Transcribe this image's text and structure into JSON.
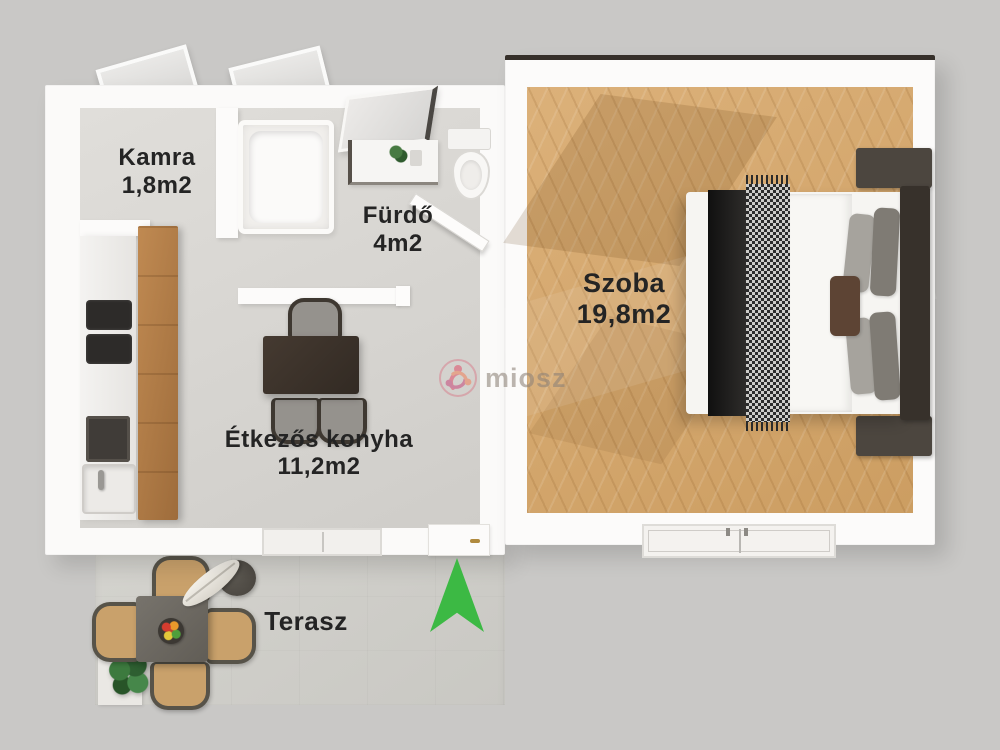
{
  "floorplan": {
    "rooms": [
      {
        "name": "Kamra",
        "area": "1,8m2"
      },
      {
        "name": "Fürdő",
        "area": "4m2"
      },
      {
        "name": "Szoba",
        "area": "19,8m2"
      },
      {
        "name": "Étkezős konyha",
        "area": "11,2m2"
      },
      {
        "name": "Terasz",
        "area": ""
      }
    ],
    "watermark": {
      "brand": "miosz",
      "logo_colors": [
        "#e0566e",
        "#ef8560",
        "#c8507f"
      ]
    },
    "compass": {
      "direction": "north",
      "color": "#3cb944"
    },
    "furniture": {
      "bathroom": [
        "bathtub",
        "mirror",
        "vanity",
        "toilet"
      ],
      "kitchen": [
        "counter",
        "cooktop",
        "oven",
        "sink",
        "tall-cabinet",
        "dining-table",
        "chairs"
      ],
      "bedroom": [
        "double-bed",
        "headboard",
        "pillows",
        "throw-blanket",
        "nightstands",
        "window"
      ],
      "terrace": [
        "square-table",
        "chairs",
        "round-stool",
        "umbrella",
        "fruit-bowl",
        "plant",
        "planter"
      ]
    },
    "colors": {
      "background": "#c9c8c6",
      "wall": "#fbfaf9",
      "floor_gray": "#d7d5d1",
      "floor_wood": "#d7a667",
      "terrace_floor": "#cfcec9",
      "cabinet_wood": "#b07c45",
      "dark_furniture": "#37312b",
      "label_text": "#242424"
    }
  }
}
